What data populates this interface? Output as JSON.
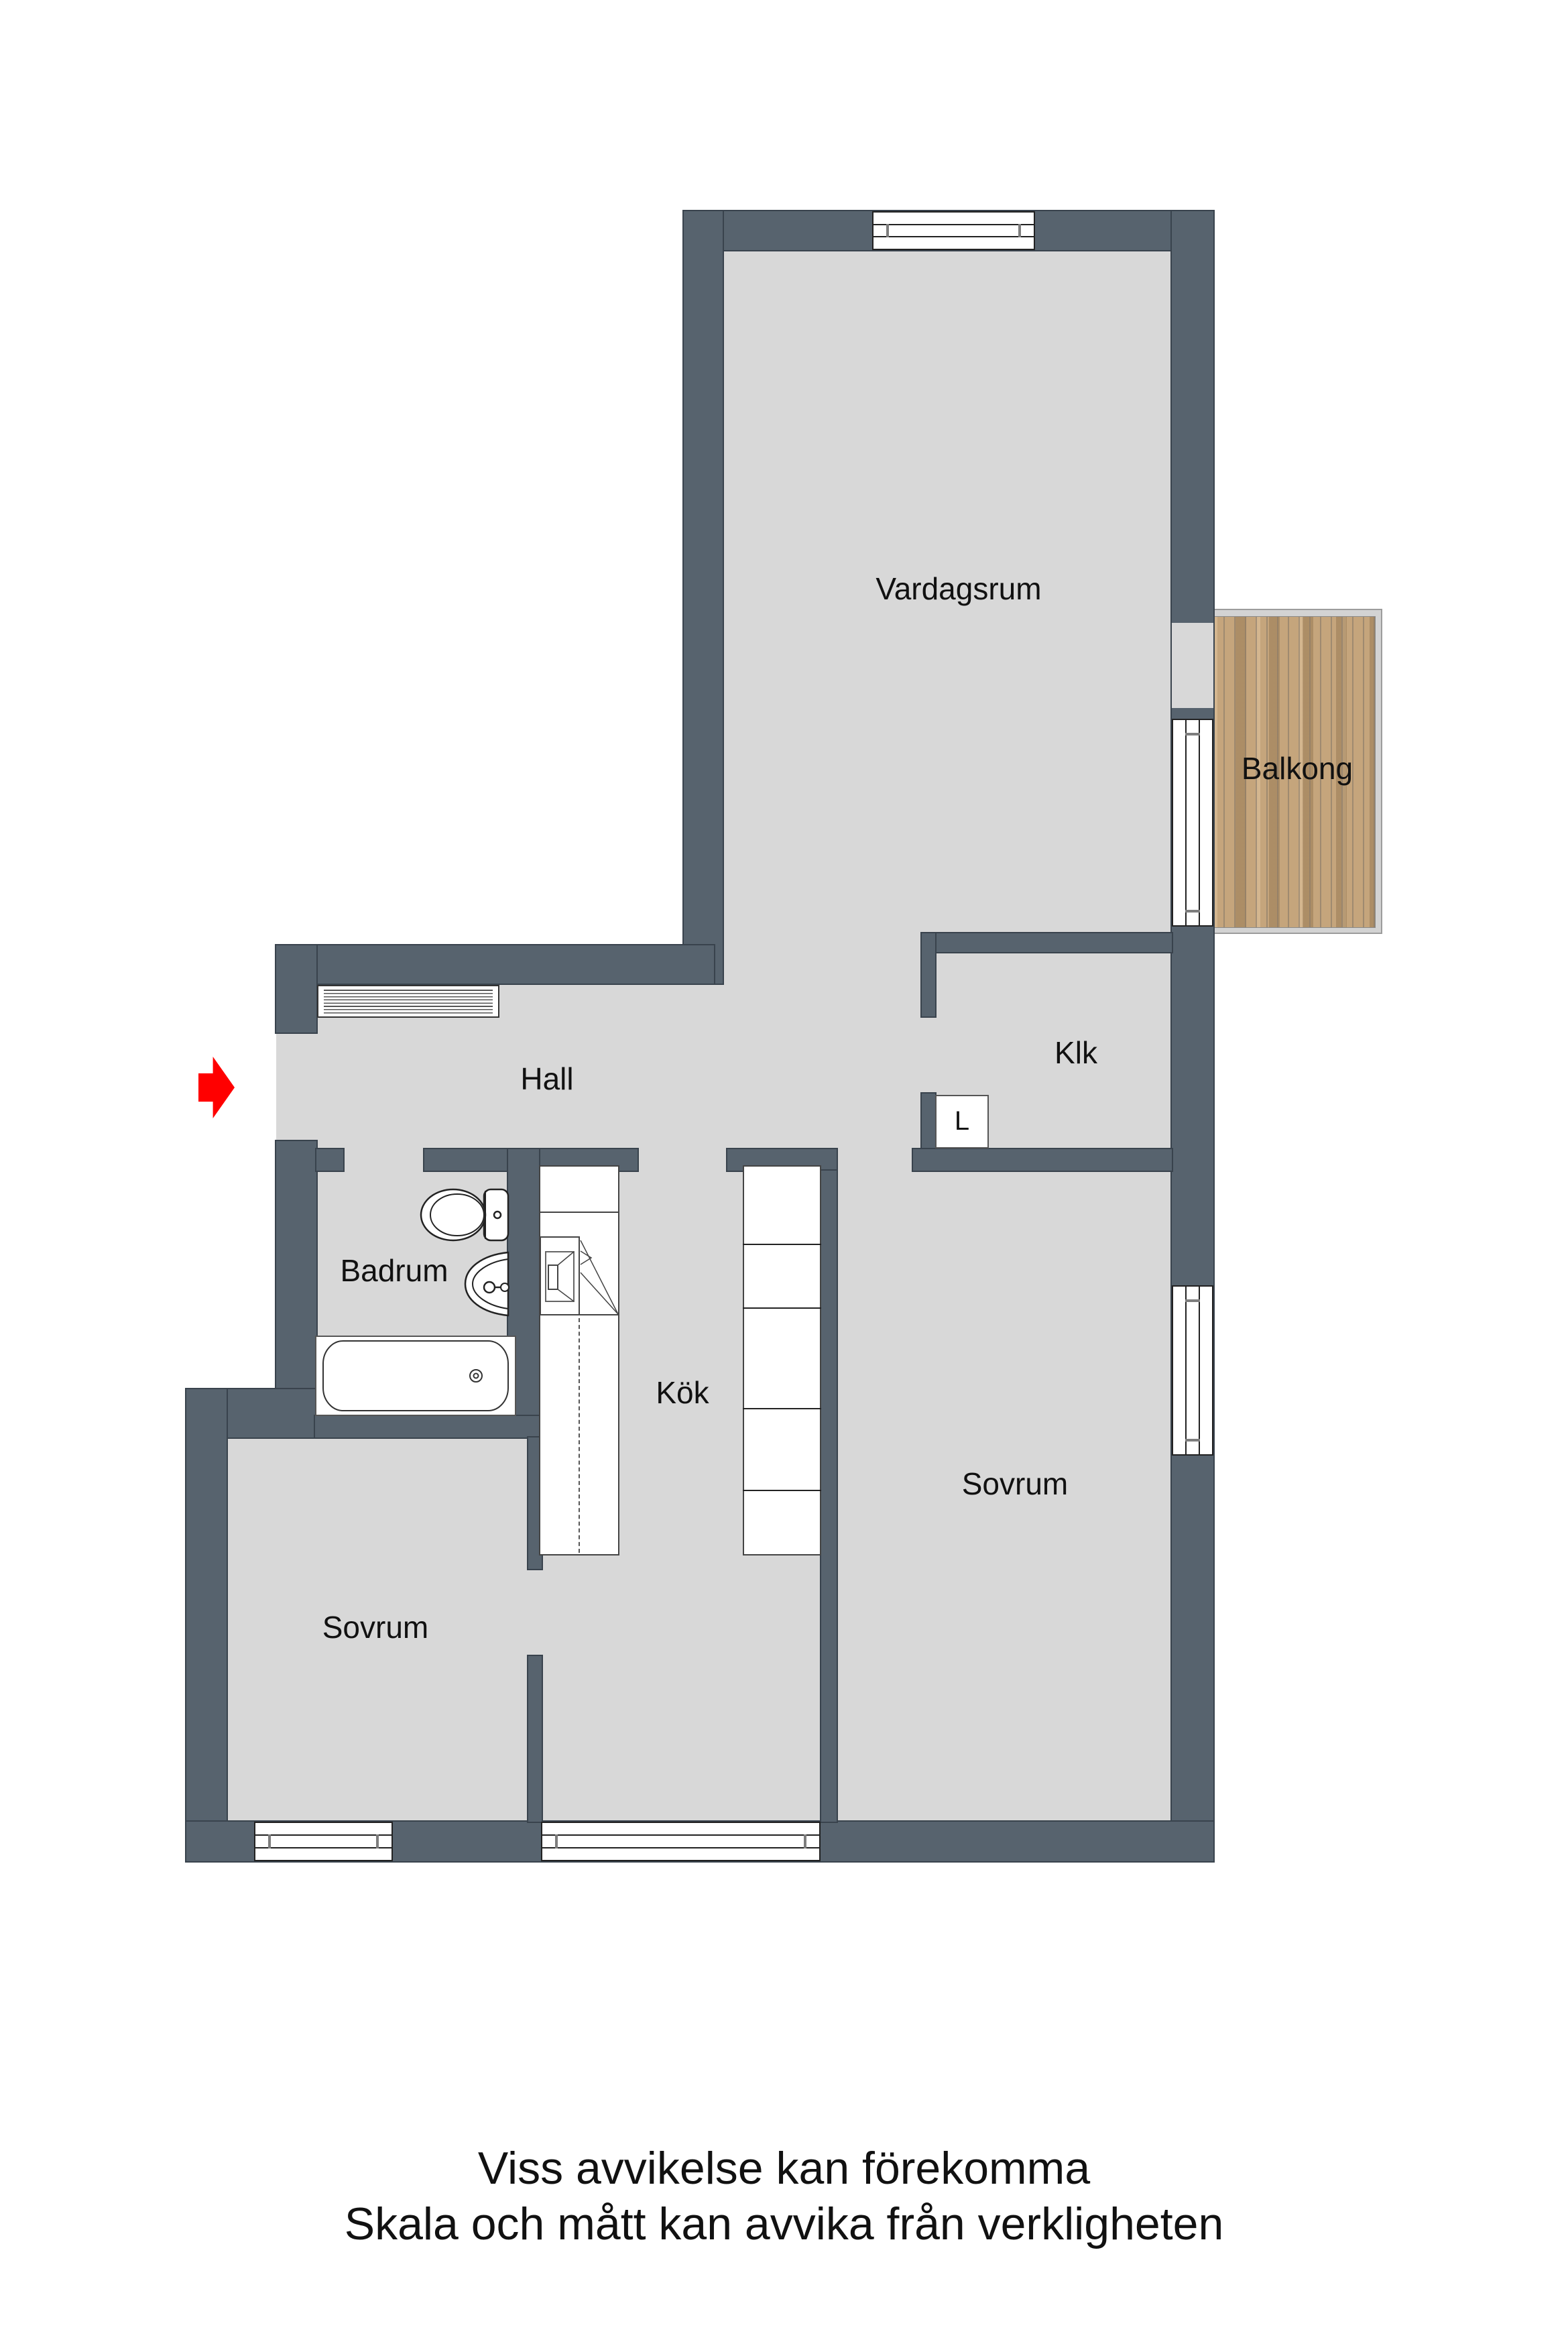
{
  "rooms": {
    "vardagsrum": "Vardagsrum",
    "balkong": "Balkong",
    "klk": "Klk",
    "hall": "Hall",
    "badrum": "Badrum",
    "kok": "Kök",
    "sovrum_right": "Sovrum",
    "sovrum_left": "Sovrum",
    "closet_l": "L"
  },
  "disclaimer": {
    "line1": "Viss avvikelse kan förekomma",
    "line2": "Skala och mått kan avvika från verkligheten"
  },
  "colors": {
    "wall": "#57636E",
    "wall_outline": "#39434D",
    "floor": "#D8D8D8",
    "balcony_frame": "#D3D3D3",
    "balcony_wood": "#C5A57C",
    "entrance_arrow": "#FF0000",
    "background": "#FFFFFF"
  },
  "icons": {
    "entrance_arrow": "entrance-arrow",
    "toilet": "toilet-icon",
    "sink": "sink-icon",
    "bathtub": "bathtub-icon",
    "stove": "stove-icon",
    "wardrobe": "wardrobe-stripes-icon",
    "window": "window-symbol",
    "balcony_door": "balcony-door-symbol"
  }
}
